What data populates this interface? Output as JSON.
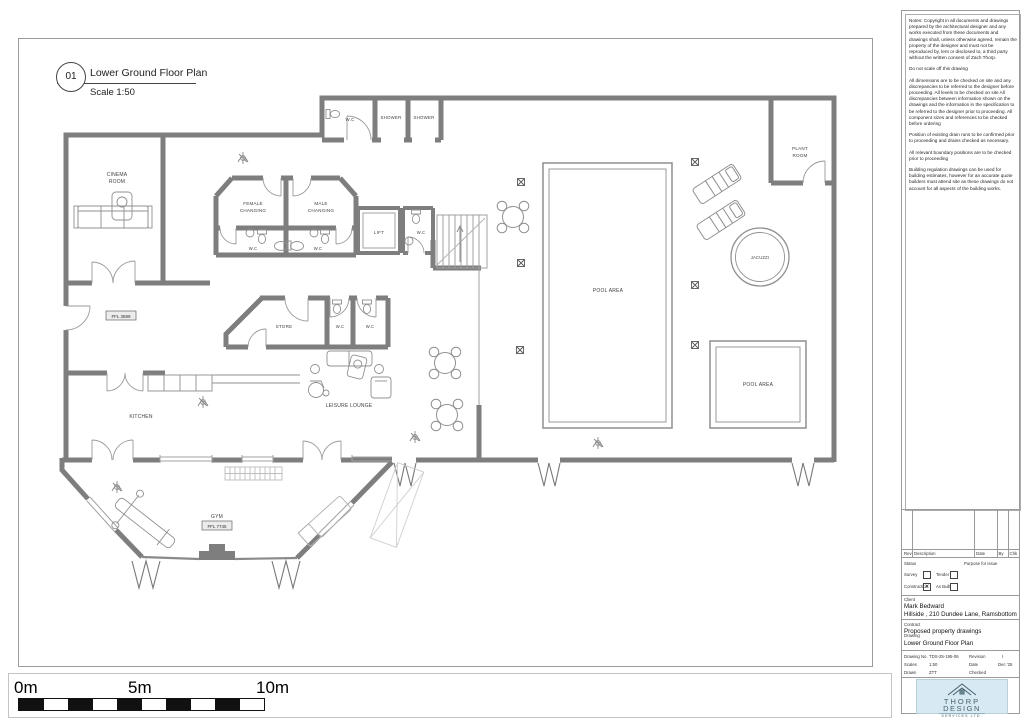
{
  "sheet": {
    "bubble_number": "01",
    "title": "Lower Ground Floor Plan",
    "scale": "Scale 1:50"
  },
  "notes": {
    "p1": "Notes: Copyright in all documents and drawings prepared by the architectural designer and any works executed from these documents and drawings shall, unless otherwise agreed, remain the property of the designer and must not be reproduced by, lent or disclosed to, a third party without the written consent of Zach Thorp.",
    "p2": "Do not scale off this drawing",
    "p3": "All dimensions are to be checked on site and any discrepancies to be referred to the designer before proceeding. All levels to be checked on site All discrepancies between information shown on the drawings and the information in the specification to be referred to the designer prior to proceeding. All component sizes and references to be checked before ordering",
    "p4": "Position of existing drain runs to be confirmed prior to proceeding and drains checked as necessary.",
    "p5": "All relevant boundary positions are to be checked prior to proceeding",
    "p6": "Building regulation drawings can be used for building estimates, however for an accurate quote builders must attend site as these drawings do not account for all aspects of the building works."
  },
  "revision_table": {
    "col_rev": "Rev",
    "col_description": "Description",
    "col_date": "Date",
    "col_by": "By",
    "col_chk": "Chk"
  },
  "status": {
    "label": "Status",
    "purpose": "Purpose for issue",
    "survey": "Survey",
    "tender": "Tender",
    "construction": "Construction",
    "as_built": "As Built",
    "survey_mark": "",
    "tender_mark": "",
    "construction_mark": "✕",
    "as_built_mark": ""
  },
  "client": {
    "label": "Client",
    "name": "Mark Bedward",
    "address": "Hillside , 210 Dundee Lane, Ramsbottom"
  },
  "contract": {
    "label": "Contract",
    "value": "Proposed property drawings"
  },
  "drawing": {
    "label": "Drawing",
    "value": "Lower Ground Floor Plan"
  },
  "drawing_info": {
    "no_label": "Drawing No.",
    "no": "TDS-25-195-06",
    "revision_label": "Revision",
    "revision": "I",
    "scales_label": "Scales",
    "scales": "1:50",
    "date_label": "Date",
    "date": "Dec '25",
    "drawn_label": "Drawn",
    "drawn": "ZTT",
    "checked_label": "Checked",
    "checked": ""
  },
  "logo": {
    "line1": "THORP",
    "line2": "DESIGN",
    "line3": "SERVICES LTD.",
    "bg": "#d7e9f2",
    "fg": "#46626e"
  },
  "scale_bar": {
    "start": "0m",
    "mid": "5m",
    "end": "10m"
  },
  "plan": {
    "labels": {
      "cinema_1": "CINEMA",
      "cinema_2": "ROOM",
      "wc_top": "W.C",
      "shower_1": "SHOWER",
      "shower_2": "SHOWER",
      "female_1": "FEMALE",
      "female_2": "CHANGING",
      "male_1": "MALE",
      "male_2": "CHANGING",
      "wc_female": "W.C",
      "wc_male": "W.C",
      "lift": "LIFT",
      "wc_lift": "W.C",
      "plant_1": "PLANT",
      "plant_2": "ROOM",
      "pool_main": "POOL AREA",
      "pool_small": "POOL AREA",
      "jacuzzi": "JACUZZI",
      "store": "STORE",
      "wc_store_1": "W.C",
      "wc_store_2": "W.C",
      "kitchen": "KITCHEN",
      "lounge": "LEISURE LOUNGE",
      "gym": "GYM",
      "level_1": "FFL 3889",
      "level_2": "FFL 7745"
    }
  }
}
